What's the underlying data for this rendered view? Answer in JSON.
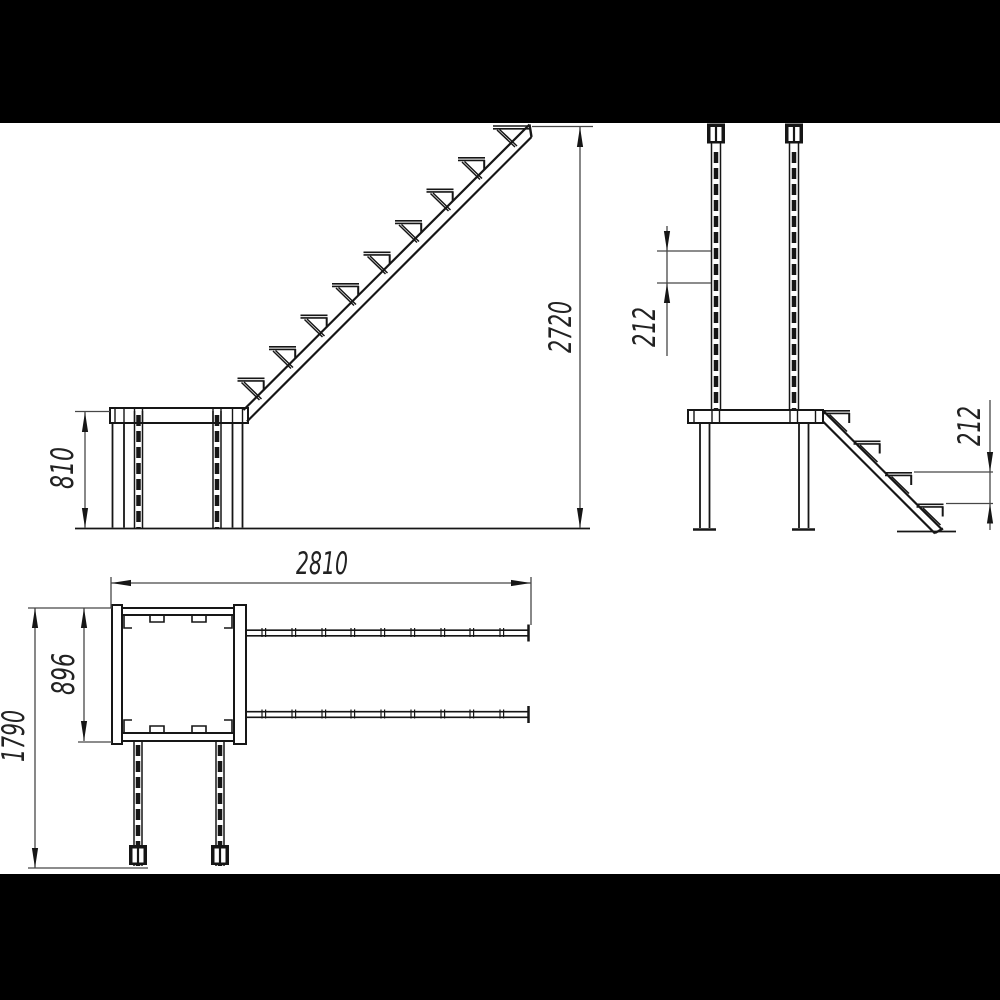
{
  "drawing": {
    "background": "#ffffff",
    "letterbox_color": "#000000",
    "line_color": "#161616",
    "dimension_line_color": "#474747",
    "text_color": "#222222",
    "dimensions": {
      "platform_height": "810",
      "total_height": "2720",
      "post_hole_spacing": "212",
      "step_rise": "212",
      "total_length": "2810",
      "platform_width": "896",
      "overall_depth": "1790"
    }
  }
}
